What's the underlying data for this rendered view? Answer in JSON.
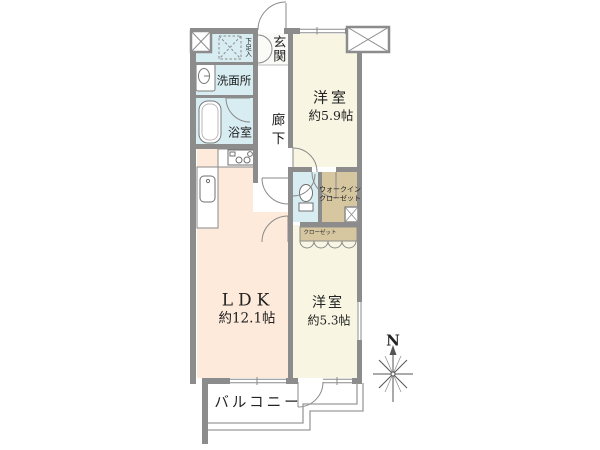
{
  "floorplan": {
    "type": "apartment-floor-plan",
    "compass": {
      "north_label": "N"
    },
    "rooms": {
      "genkan": {
        "label": "玄関"
      },
      "shoe_box": {
        "label": "下足入"
      },
      "washroom": {
        "label": "洗面所"
      },
      "bathroom": {
        "label": "浴室"
      },
      "corridor": {
        "label": "廊下"
      },
      "bedroom1": {
        "label": "洋室",
        "size": "約5.9帖"
      },
      "walk_in_closet": {
        "label_line1": "ウォークイン",
        "label_line2": "クローゼット"
      },
      "closet": {
        "label": "クローゼット"
      },
      "ldk": {
        "label": "LDK",
        "size": "約12.1帖"
      },
      "bedroom2": {
        "label": "洋室",
        "size": "約5.3帖"
      },
      "balcony": {
        "label": "バルコニー"
      }
    },
    "colors": {
      "wall": "#8c8c8c",
      "wet_area_floor": "#d8edf2",
      "western_room_floor": "#f8f6e2",
      "ldk_floor": "#fdeadb",
      "closet_floor": "#d6c7a1",
      "outline": "#9a9a9a",
      "text": "#222222"
    }
  }
}
